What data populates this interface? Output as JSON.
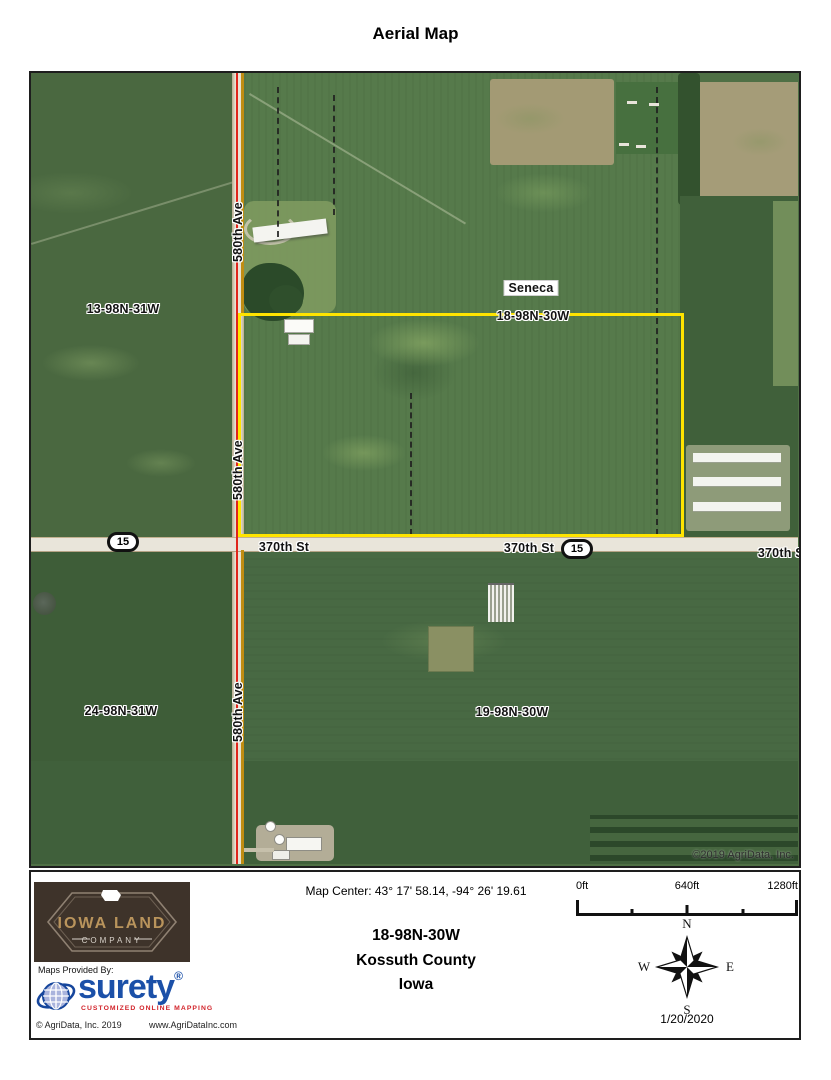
{
  "title": "Aerial Map",
  "map": {
    "roads": {
      "vertical": "580th Ave",
      "horizontal": "370th St"
    },
    "highway_shield": "15",
    "place_label": "Seneca",
    "sections": {
      "nw": "13-98N-31W",
      "ne": "18-98N-30W",
      "sw": "24-98N-31W",
      "se": "19-98N-30W"
    },
    "copyright": "©2019 AgriData, Inc."
  },
  "footer": {
    "map_center": "Map Center: 43° 17' 58.14,  -94° 26' 19.61",
    "location": {
      "township": "18-98N-30W",
      "county": "Kossuth County",
      "state": "Iowa"
    },
    "scale": {
      "start": "0ft",
      "mid": "640ft",
      "end": "1280ft"
    },
    "compass": {
      "n": "N",
      "e": "E",
      "s": "S",
      "w": "W"
    },
    "date": "1/20/2020",
    "iowa_land_logo": {
      "line1": "IOWA LAND",
      "line2": "COMPANY"
    },
    "provider": {
      "label": "Maps Provided By:",
      "brand": "surety",
      "registered": "®",
      "tagline": "CUSTOMIZED ONLINE MAPPING",
      "copyright": "© AgriData, Inc. 2019",
      "website": "www.AgriDataInc.com"
    }
  },
  "colors": {
    "parcel_boundary": "#ffe400",
    "highway_centerline_red": "#e0251c",
    "section_line_gold": "#c08d12",
    "surety_blue": "#1b50a8",
    "tagline_red": "#d2232a",
    "logo_brown": "#3e332a",
    "logo_gold": "#b9945c"
  }
}
